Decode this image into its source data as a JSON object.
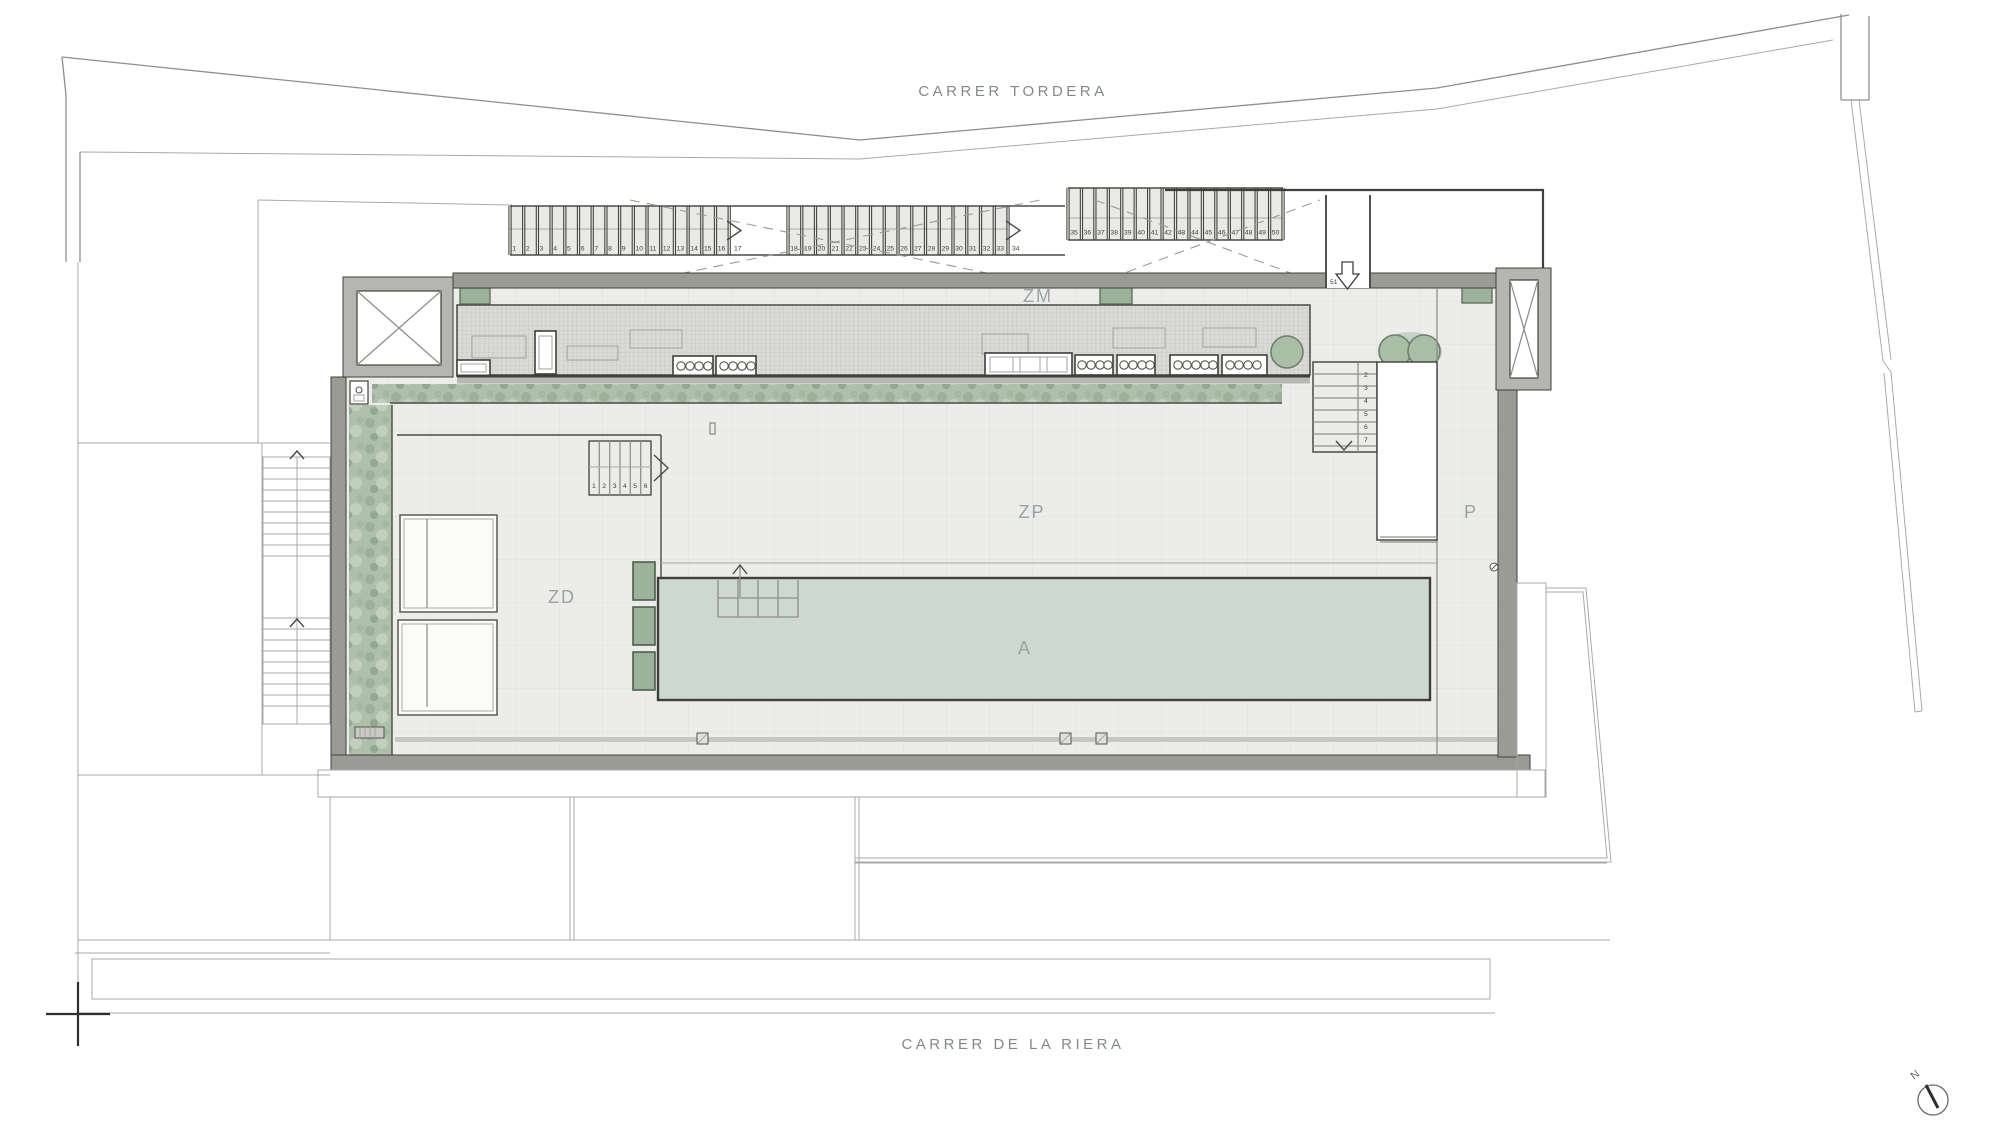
{
  "plan": {
    "streets": {
      "top": "CARRER TORDERA",
      "bottom": "CARRER DE LA RIERA"
    },
    "zones": {
      "machinery": "ZM",
      "pool_deck": "ZP",
      "deck": "ZD",
      "pool": "A",
      "passage": "P"
    },
    "parking": {
      "group1": {
        "numbers": [
          "1",
          "2",
          "3",
          "4",
          "5",
          "6",
          "7",
          "8",
          "9",
          "10",
          "11",
          "12",
          "13",
          "14",
          "15",
          "16"
        ],
        "wide_bay": "17"
      },
      "group2": {
        "numbers": [
          "18",
          "19",
          "20",
          "21",
          "22",
          "23",
          "24",
          "25",
          "26",
          "27",
          "28",
          "29",
          "30",
          "31",
          "32",
          "33"
        ],
        "wide_bay": "34"
      },
      "group3": {
        "numbers": [
          "35",
          "36",
          "37",
          "38",
          "39",
          "40",
          "41",
          "42",
          "43",
          "44",
          "45",
          "46",
          "47",
          "48",
          "49",
          "50"
        ]
      },
      "ramp_bay": "51"
    },
    "stairs": {
      "deck_stair": [
        "1",
        "2",
        "3",
        "4",
        "5",
        "6"
      ],
      "upper_stair": [
        "2",
        "3",
        "4",
        "5",
        "6",
        "7"
      ]
    },
    "compass": {
      "north": "N"
    },
    "colors": {
      "pool": "#ccd8d0",
      "hedge": "#a9bda7",
      "planter": "#9cb29a",
      "wall": "#9b9b96",
      "deck": "#ececea",
      "label": "#9aa3a1",
      "street_label": "#84888c"
    }
  }
}
